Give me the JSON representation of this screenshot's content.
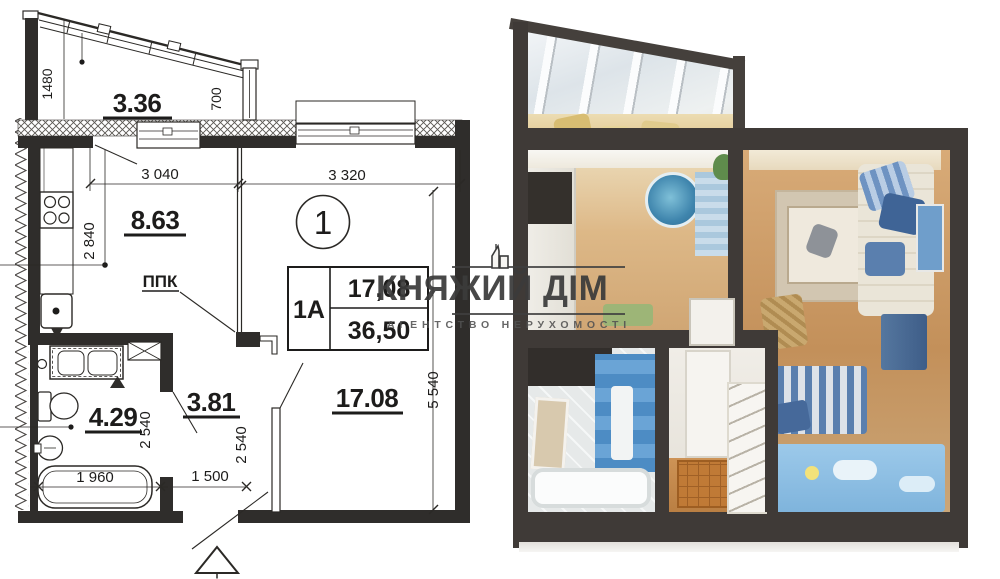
{
  "floor_plan": {
    "unit_marker": "1",
    "unit_table": {
      "type": "1А",
      "area_living": "17,08",
      "area_total": "36,50"
    },
    "areas": {
      "balcony": "3.36",
      "kitchen": "8.63",
      "bathroom": "4.29",
      "hallway": "3.81",
      "living_room": "17.08"
    },
    "labels": {
      "ppk": "ППК",
      "tub_length": "1 960"
    },
    "dimensions": {
      "balcony_left_height": "1480",
      "balcony_right_width": "700",
      "kitchen_width": "3 040",
      "living_width": "3 320",
      "kitchen_axis": "2 840",
      "bathroom_depth": "2 540",
      "hallway_depth": "2 540",
      "hallway_width": "1 500",
      "living_depth": "5 540"
    }
  },
  "watermark": {
    "title": "КНЯЖИЙ ДІМ",
    "subtitle": "АГЕНТСТВО НЕРУХОМОСТІ",
    "logo_icon": "building-icon",
    "text_color": "#3b3b3b"
  },
  "colors": {
    "plan_line": "#2b2926",
    "plan_wall_fill": "#2f2d2b",
    "render_wall": "#3f3a37",
    "wood_floor": "#c99a66",
    "blue_furniture": "#5e8fc0",
    "blue_tile": "#4a86c2",
    "blue_carpet": "#8cc0e4"
  }
}
